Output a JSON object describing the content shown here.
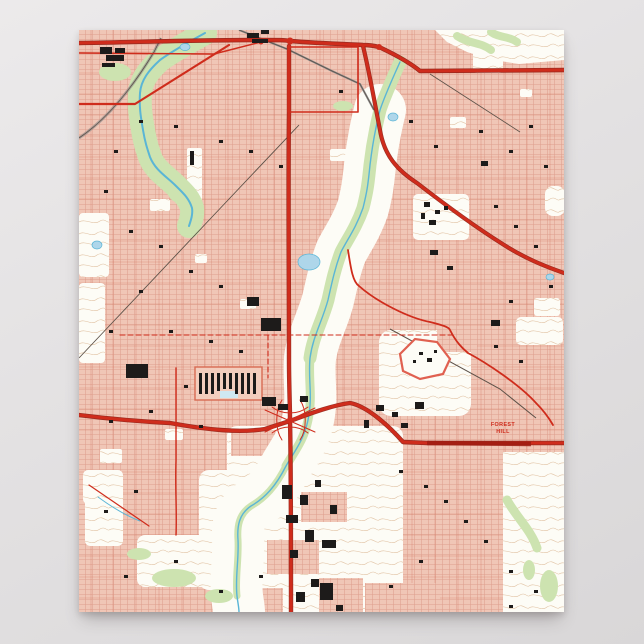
{
  "scene": {
    "description": "vintage topographic city map poster on gray backdrop",
    "background": "#e4e2e3"
  },
  "map": {
    "labels": {
      "forest_hill": {
        "line1": "FOREST",
        "line2": "HILL"
      }
    },
    "colors": {
      "urban": "#f0c6b6",
      "grid": "#dfa08e",
      "nonurban": "#fdfcf6",
      "vegetation": "#cde3b0",
      "vegetation_dark": "#b9d698",
      "water": "#5ab5d6",
      "water_fill": "#aed6ea",
      "highway": "#cf2c1c",
      "highway_dark": "#8e1a10",
      "arterial": "#d2705a",
      "building": "#1d1b1a",
      "contour": "#d8b08a",
      "railroad": "#8a8a8a",
      "background": "#e4e2e3"
    }
  }
}
